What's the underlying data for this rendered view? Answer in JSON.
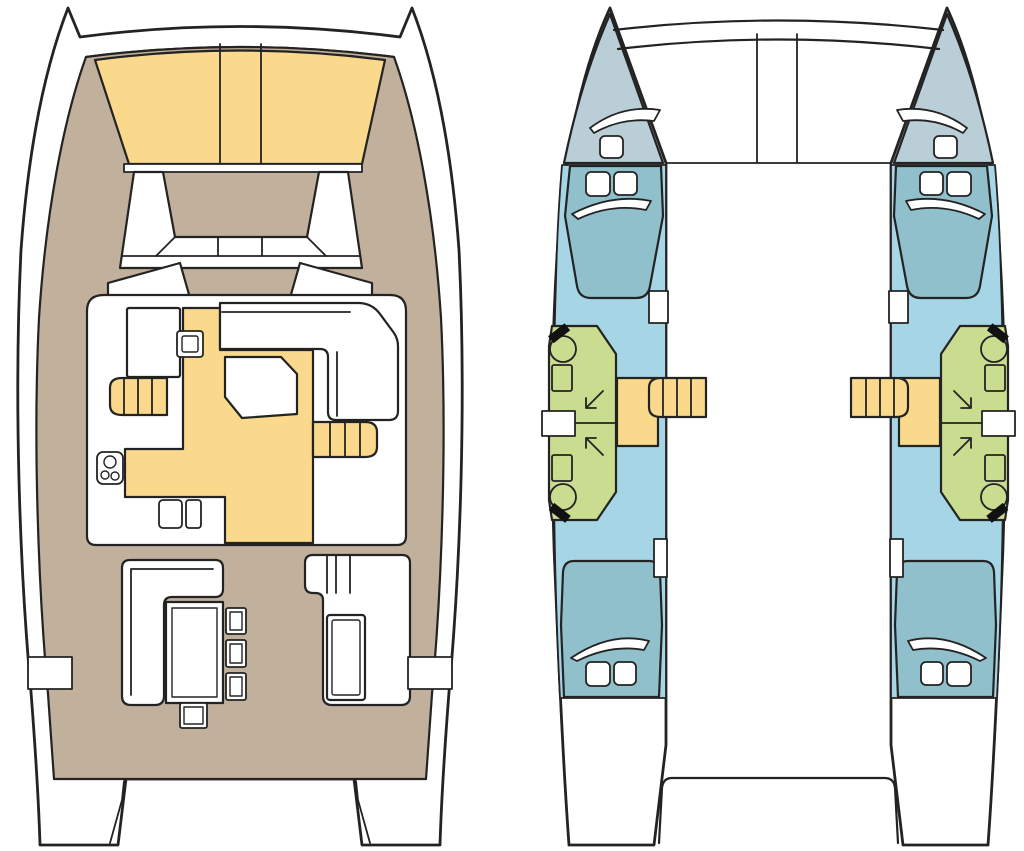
{
  "diagram": {
    "type": "catamaran-yacht-floor-plan",
    "views": [
      {
        "id": "deck-plan",
        "position": "left",
        "elements": [
          "bow-trampoline",
          "foredeck-bench",
          "front-windows",
          "saloon",
          "galley-floor",
          "galley-counter",
          "sink",
          "stove-3-burners",
          "fridge-boxes",
          "saloon-table",
          "l-settee",
          "companionway-steps-port",
          "companionway-steps-starboard",
          "cockpit-bench",
          "cockpit-table",
          "stools",
          "aft-module-seat",
          "side-boarding-gates",
          "transom-platforms"
        ]
      },
      {
        "id": "hull-plan",
        "position": "right",
        "elements": [
          "port-hull",
          "starboard-hull",
          "forepeak-hatch",
          "fore-cabin-double-bed",
          "bathroom-fore",
          "bathroom-aft",
          "toilets",
          "washbasins",
          "shower-symbols",
          "vanity",
          "companionway-steps",
          "landing",
          "aft-cabin-double-bed",
          "stern-platform",
          "forward-crossbeam"
        ]
      }
    ],
    "counts": {
      "hulls": 2,
      "cabins": 4,
      "double_beds": 4,
      "bathrooms": 4,
      "toilets": 4,
      "companionway_steps": 2
    }
  },
  "colors": {
    "outline": "#232323",
    "hull_white": "#ffffff",
    "deck_tan": "#c1b09b",
    "canvas_yellow": "#fad98d",
    "cabin_blue": "#a6d6e6",
    "bed_teal": "#8fc0cb",
    "bow_gray": "#b9ced6",
    "bath_green": "#c9dc90",
    "detail_black": "#111111",
    "background": "#ffffff"
  }
}
